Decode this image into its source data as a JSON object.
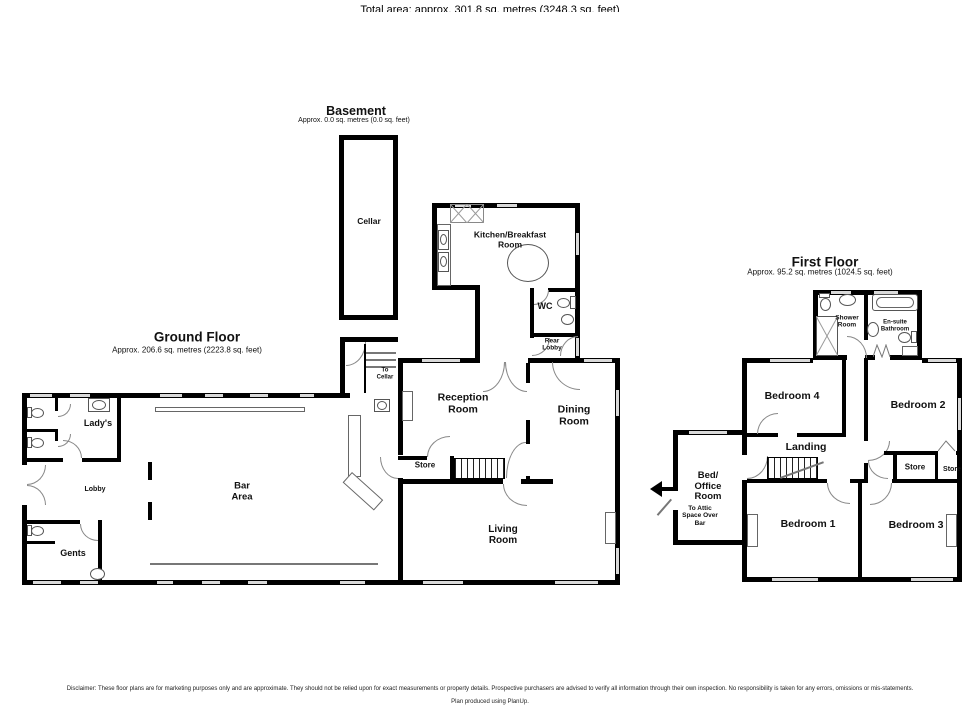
{
  "basement": {
    "title": "Basement",
    "subtitle": "Approx. 0.0 sq. metres (0.0 sq. feet)",
    "rooms": {
      "cellar": "Cellar"
    }
  },
  "ground": {
    "title": "Ground Floor",
    "subtitle": "Approx. 206.6 sq. metres (2223.8 sq. feet)",
    "rooms": {
      "kitchen": "Kitchen/Breakfast\nRoom",
      "wc": "WC",
      "rear_lobby": "Rear\nLobby",
      "reception": "Reception\nRoom",
      "dining": "Dining\nRoom",
      "store": "Store",
      "living": "Living\nRoom",
      "to_cellar": "To\nCellar",
      "ladys": "Lady's",
      "lobby": "Lobby",
      "gents": "Gents",
      "bar": "Bar\nArea"
    }
  },
  "first": {
    "title": "First Floor",
    "subtitle": "Approx. 95.2 sq. metres (1024.5 sq. feet)",
    "rooms": {
      "shower": "Shower\nRoom",
      "ensuite": "En-suite\nBathroom",
      "bed4": "Bedroom 4",
      "bed2": "Bedroom 2",
      "landing": "Landing",
      "store1": "Store",
      "store2": "Store",
      "bed_office": "Bed/\nOffice\nRoom",
      "attic_note": "To Attic\nSpace Over\nBar",
      "bed1": "Bedroom 1",
      "bed3": "Bedroom 3"
    }
  },
  "footer": {
    "total_area": "Total area: approx. 301.8 sq. metres (3248.3 sq. feet)",
    "disclaimer": "Disclaimer: These floor plans are for marketing purposes only and are approximate. They should not be relied upon for exact measurements or property details. Prospective purchasers are advised to verify all information through their own inspection. No responsibility is taken for any errors, omissions or mis-statements.",
    "credit": "Plan produced using PlanUp."
  },
  "colors": {
    "wall": "#000000",
    "window": "#d9d9d9"
  }
}
